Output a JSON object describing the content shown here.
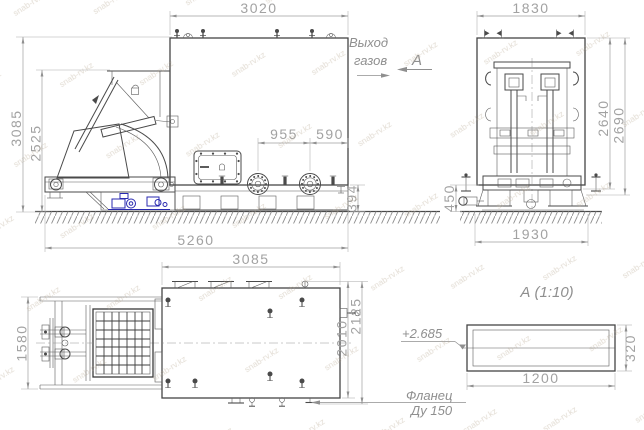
{
  "watermark": {
    "text": "snab-rv.kz"
  },
  "labels": {
    "gas_outlet_line1": "Выход",
    "gas_outlet_line2": "газов",
    "view_letter": "А",
    "detail_title": "А  (1:10)",
    "elevation_mark": "+2.685",
    "flange_note_line1": "Фланец",
    "flange_note_line2": "Ду 150"
  },
  "front_view": {
    "dim_body_width": "3020",
    "dim_total_height": "3085",
    "dim_tipper_height": "2525",
    "dim_total_length": "5260",
    "dim_flange_spacing": "955",
    "dim_flange_to_edge": "590",
    "dim_base_height": "394"
  },
  "side_view": {
    "dim_top_width": "1830",
    "dim_height_inner": "2640",
    "dim_height_outer": "2690",
    "dim_base_height": "450",
    "dim_base_width": "1930"
  },
  "plan_view": {
    "dim_body_width": "3085",
    "dim_tipper_width": "1580",
    "dim_depth_inner": "2010",
    "dim_depth_outer": "2125"
  },
  "detail_a": {
    "dim_length": "1200",
    "dim_height": "320"
  },
  "colors": {
    "drawing_line": "#4a4a4a",
    "dimension_text": "#a2a2a2",
    "hydraulic_blue": "#2a2ab0",
    "ground_hatch": "#8f8f8f",
    "watermark": "#b3a28c"
  }
}
